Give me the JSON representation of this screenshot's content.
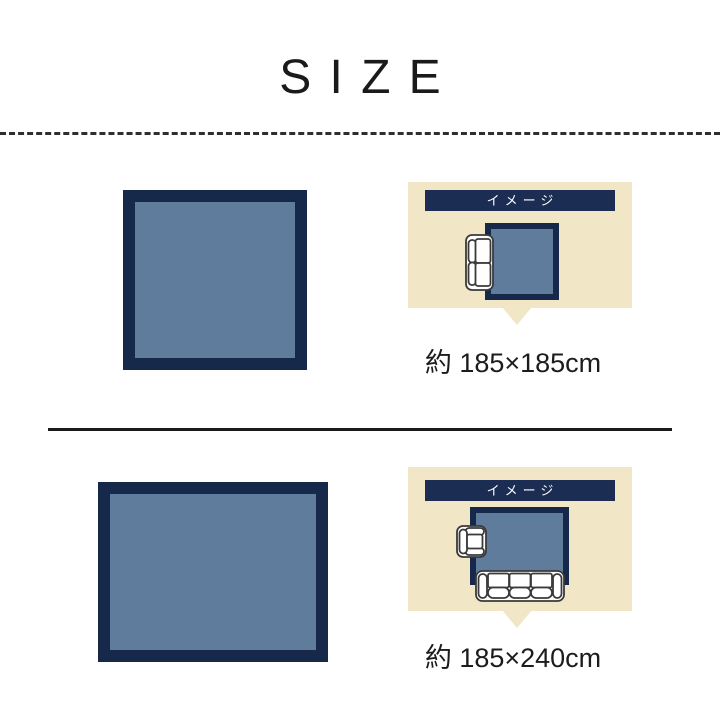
{
  "title": "SIZE",
  "colors": {
    "navy": "#16294a",
    "header_navy": "#1b2d52",
    "rug_fill": "#5f7c9c",
    "cream": "#f1e6c6",
    "text_dark": "#1c1c1c",
    "furniture_outline": "#3a3a3a",
    "header_text": "#ffffff"
  },
  "sections": [
    {
      "image_label": "イメージ",
      "size_text": "約 185×185cm",
      "rug_shape": "square",
      "furniture": [
        "two-seat-sofa"
      ]
    },
    {
      "image_label": "イメージ",
      "size_text": "約 185×240cm",
      "rug_shape": "landscape-rectangle",
      "furniture": [
        "one-seat-armchair",
        "three-seat-sofa"
      ]
    }
  ]
}
